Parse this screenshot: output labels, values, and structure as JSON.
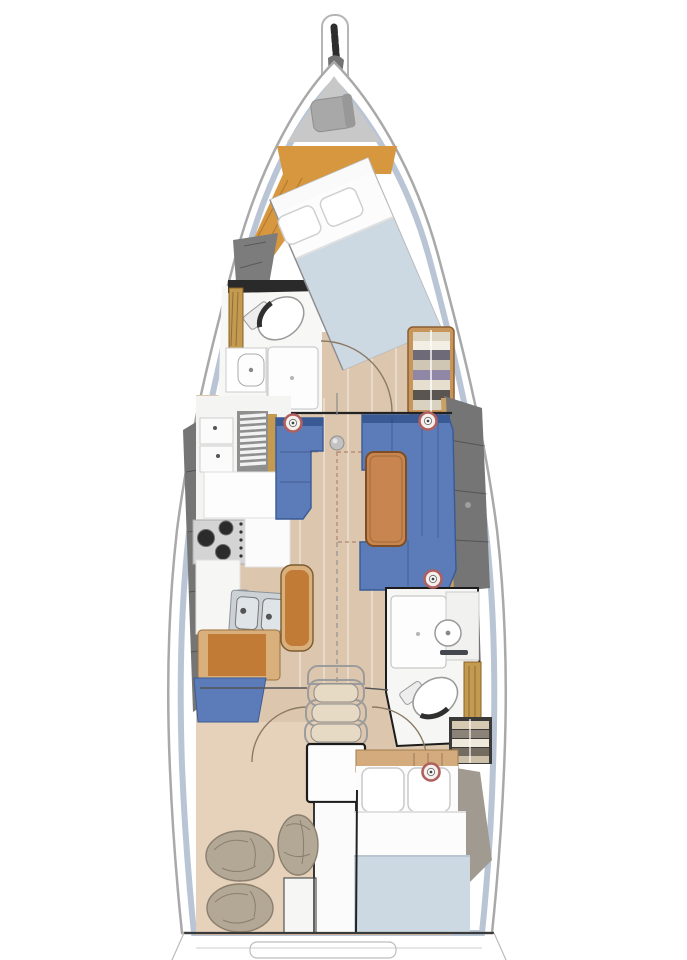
{
  "diagram": {
    "type": "boat-floor-plan",
    "regions": [
      "bowsprit",
      "anchor-locker",
      "forward-cabin",
      "forward-head",
      "galley",
      "saloon",
      "port-settee",
      "starboard-settee",
      "saloon-table",
      "nav-bench",
      "companionway-steps",
      "engine-compartment",
      "aft-head",
      "aft-cabin",
      "sail-locker",
      "transom"
    ],
    "marker_count": 4
  },
  "palette": {
    "page_bg": "#ffffff",
    "hull_fill": "#ffffff",
    "hull_stroke": "#a9a9a9",
    "liner": "#b9c5d5",
    "side_wedge": "#757575",
    "side_wedge_fwd": "#7c7c7c",
    "floor": "#dcc6ad",
    "storage_floor": "#e6d2ba",
    "floor_fwd_wood": "#d6973f",
    "anchor_locker": "#c8c8c8",
    "windlass": "#a8a8a8",
    "chain": "#2e2e2e",
    "mattress": "#ccd8e2",
    "linen": "#fcfcfc",
    "pillow": "#ffffff",
    "settee": "#5b7cb8",
    "settee_dark": "#3a5a96",
    "table_wood": "#c9854f",
    "bench_orange": "#c27a37",
    "bench_trim": "#d9b07c",
    "counter": "#f4f4f2",
    "head_floor": "#f7f7f5",
    "steel": "#d4d4d4",
    "burner": "#2b2b2b",
    "sink_steel": "#ccd1d6",
    "louver": "#8f8f8f",
    "wood_gold": "#c49a50",
    "wood_band": "#d4ab7c",
    "marker_ring": "#b05f5f",
    "bag": "#b3a795",
    "bulkhead": "#2a2a2a",
    "outline_dark": "#1c1c1c",
    "door_arc": "#8a7a66",
    "dashed_leaf": "#b08570",
    "towels_fwd": [
      "#ddd5c4",
      "#f2eee3",
      "#6f6a78",
      "#cfc7b4",
      "#8f87a5",
      "#e6dfd0",
      "#5a5550",
      "#d9d2c0"
    ],
    "towels_aft": [
      "#d6c9b2",
      "#8b8378",
      "#efe9db",
      "#746b60",
      "#cbbfa8"
    ],
    "shelf_frame": "#c8965a"
  }
}
